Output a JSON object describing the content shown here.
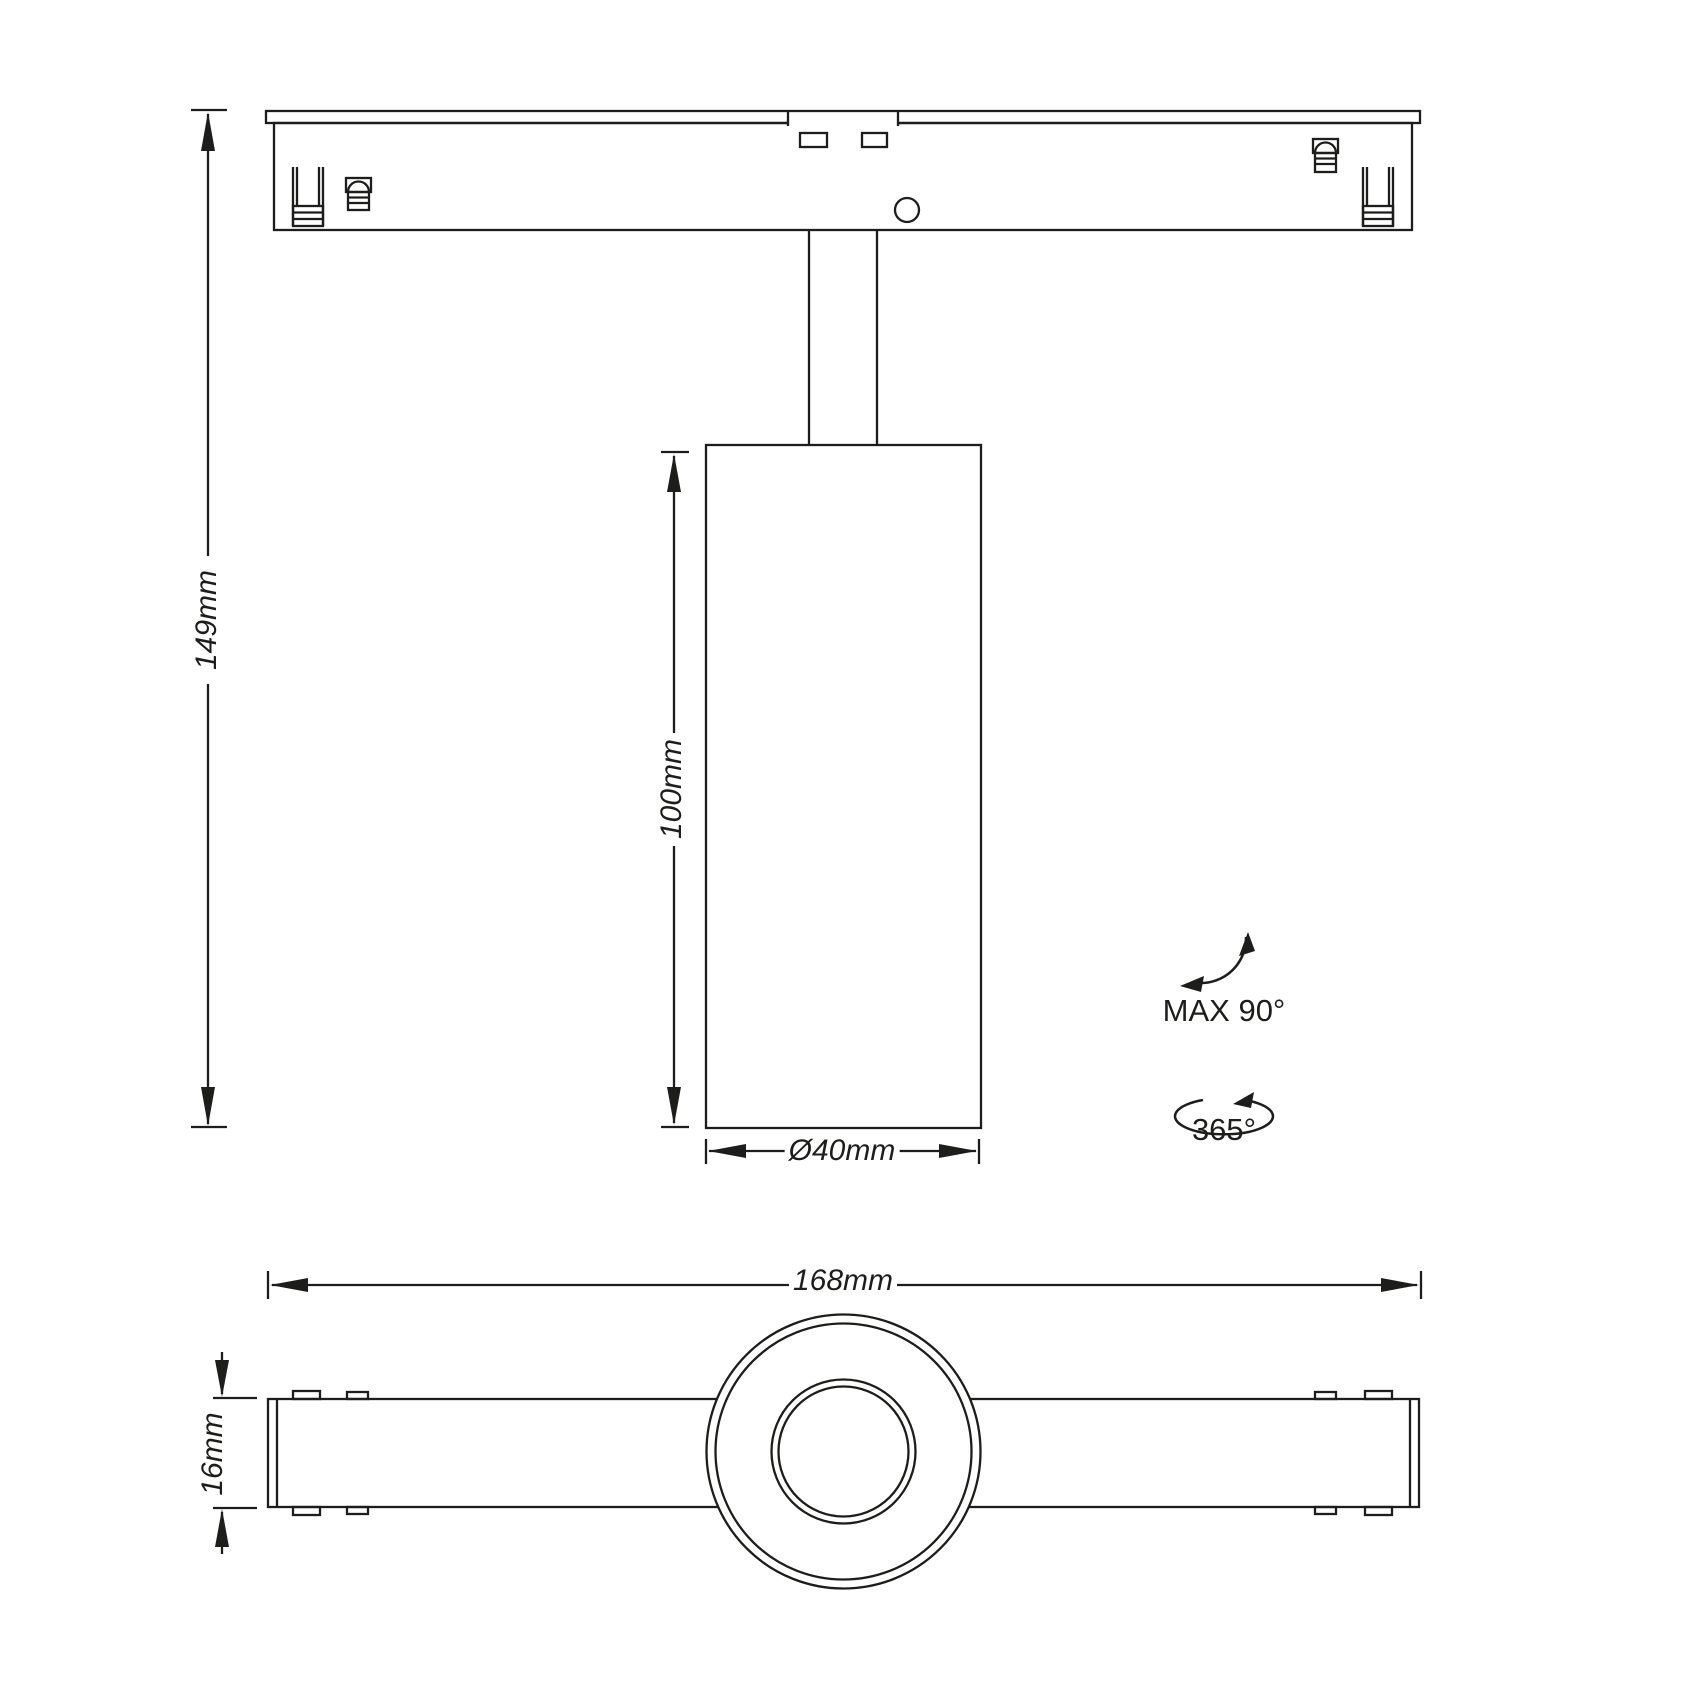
{
  "colors": {
    "line": "#1d1d1b",
    "background": "#ffffff"
  },
  "side_view": {
    "overall_height_label": "149mm",
    "body_height_label": "100mm",
    "body_diameter_label": "Ø40mm",
    "tilt_label": "MAX 90°",
    "rotation_label": "365°"
  },
  "top_view": {
    "overall_length_label": "168mm",
    "track_width_label": "16mm"
  }
}
